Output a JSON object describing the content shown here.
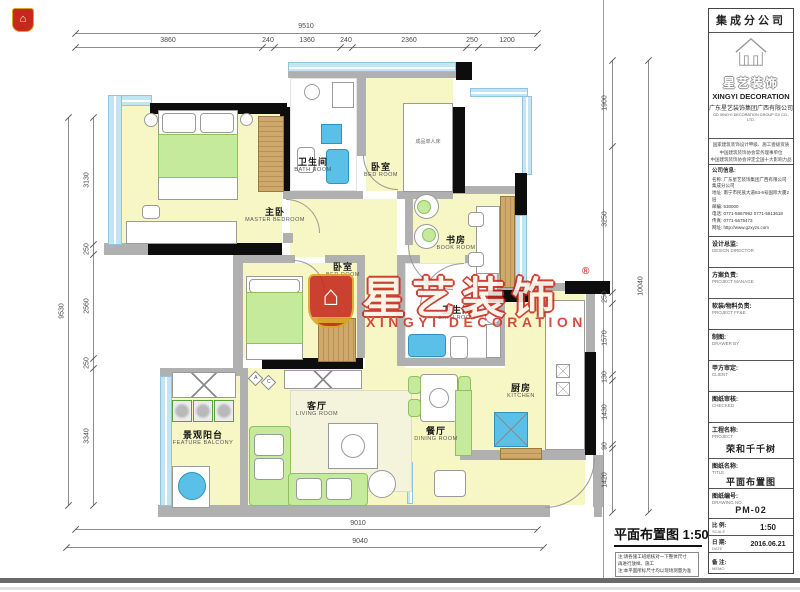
{
  "icons": {
    "house": "⌂"
  },
  "colors": {
    "watermark_red": "#c6281c",
    "gold": "#d9a520",
    "window_blue": "#c3e5f3",
    "floor_yellow": "#f7f7c5",
    "fixture_blue": "#5bc0e8",
    "furniture_green": "#c5ea9b"
  },
  "watermark": {
    "cn": "星艺装饰",
    "reg": "®",
    "en": "XINGYI DECORATION"
  },
  "sheet": {
    "plan_title": "平面布置图",
    "plan_scale": "1:50",
    "notes": [
      "注:请各施工班组核对一下整体尺寸",
      "再进行放样、施工",
      "注:本平面所标尺寸均以现场测量为准"
    ]
  },
  "rooms": [
    {
      "zh": "主卧",
      "en": "MASTER BEDROOM"
    },
    {
      "zh": "卫生间",
      "en": "BATH ROOM"
    },
    {
      "zh": "卧室",
      "en": "BED ROOM"
    },
    {
      "zh": "书房",
      "en": "BOOK ROOM"
    },
    {
      "zh": "卧室",
      "en": "BED ROOM"
    },
    {
      "zh": "卫生间",
      "en": "BATH ROOM"
    },
    {
      "zh": "厨房",
      "en": "KITCHEN"
    },
    {
      "zh": "餐厅",
      "en": "DINING ROOM"
    },
    {
      "zh": "客厅",
      "en": "LIVING ROOM"
    },
    {
      "zh": "景观阳台",
      "en": "FEATURE BALCONY"
    }
  ],
  "annotations": {
    "bed_label": "成品单人床",
    "ac_a": "A",
    "ac_c": "C"
  },
  "dims": {
    "top": {
      "total": "9510",
      "segments": [
        "3860",
        "240",
        "1360",
        "240",
        "2360",
        "250",
        "1200"
      ]
    },
    "left": {
      "total": "9530",
      "segments": [
        "3130",
        "250",
        "2560",
        "250",
        "3340"
      ]
    },
    "right": {
      "total": "10040",
      "segments": [
        "1900",
        "3250",
        "250",
        "1570",
        "130",
        "1430",
        "90",
        "1420"
      ]
    },
    "bottom": {
      "inner": "9010",
      "outer": "9040"
    }
  },
  "titleblock": {
    "branch": "集成分公司",
    "brand_cn": "星艺装饰",
    "brand_en": "XINGYI DECORATION",
    "company_cn": "广东星艺装饰集团广西有限公司",
    "company_en": "GD XINGYI DECORATION GROUP GX CO., LTD.",
    "certs": [
      "国家建筑装饰设计甲级、施工壹级资质",
      "中国建筑装饰协会常务理事单位",
      "中国建筑装饰协会评定全国十大影响力品牌"
    ],
    "info_label": "公司信息:",
    "info": [
      {
        "label": "名称:",
        "value": "广东星艺装饰集团广西有限公司 集成分公司"
      },
      {
        "label": "地址:",
        "value": "南宁市民族大道63-6号国际大厦2层"
      },
      {
        "label": "邮编:",
        "value": "530000"
      },
      {
        "label": "电话:",
        "value": "0771-5867992  0771-5813618"
      },
      {
        "label": "传真:",
        "value": "0771-5675473"
      },
      {
        "label": "网址:",
        "value": "http://www.gzxyzs.com"
      }
    ],
    "fields": [
      {
        "zh": "设计总监:",
        "en": "DESIGN DIRECTOR"
      },
      {
        "zh": "方案负责:",
        "en": "PROJECT MANAGE"
      },
      {
        "zh": "软装/物料负责:",
        "en": "PROJECT FF&E"
      },
      {
        "zh": "制图:",
        "en": "DRAWER BY"
      },
      {
        "zh": "甲方审定:",
        "en": "CLIENT"
      },
      {
        "zh": "图纸审核:",
        "en": "CHECKED"
      }
    ],
    "project": {
      "zh": "工程名称:",
      "en": "PROJECT",
      "value": "荣和千千树"
    },
    "drawing": {
      "zh": "图纸名称:",
      "en": "TITLE",
      "value": "平面布置图"
    },
    "number": {
      "zh": "图纸编号:",
      "en": "DRAWING NO.",
      "value": "PM-02"
    },
    "scale": {
      "zh": "比 例:",
      "en": "SCALE",
      "value": "1:50"
    },
    "date": {
      "zh": "日 期:",
      "en": "DATE",
      "value": "2016.06.21"
    },
    "memo": {
      "zh": "备 注:",
      "en": "MEMO",
      "value": ""
    }
  }
}
